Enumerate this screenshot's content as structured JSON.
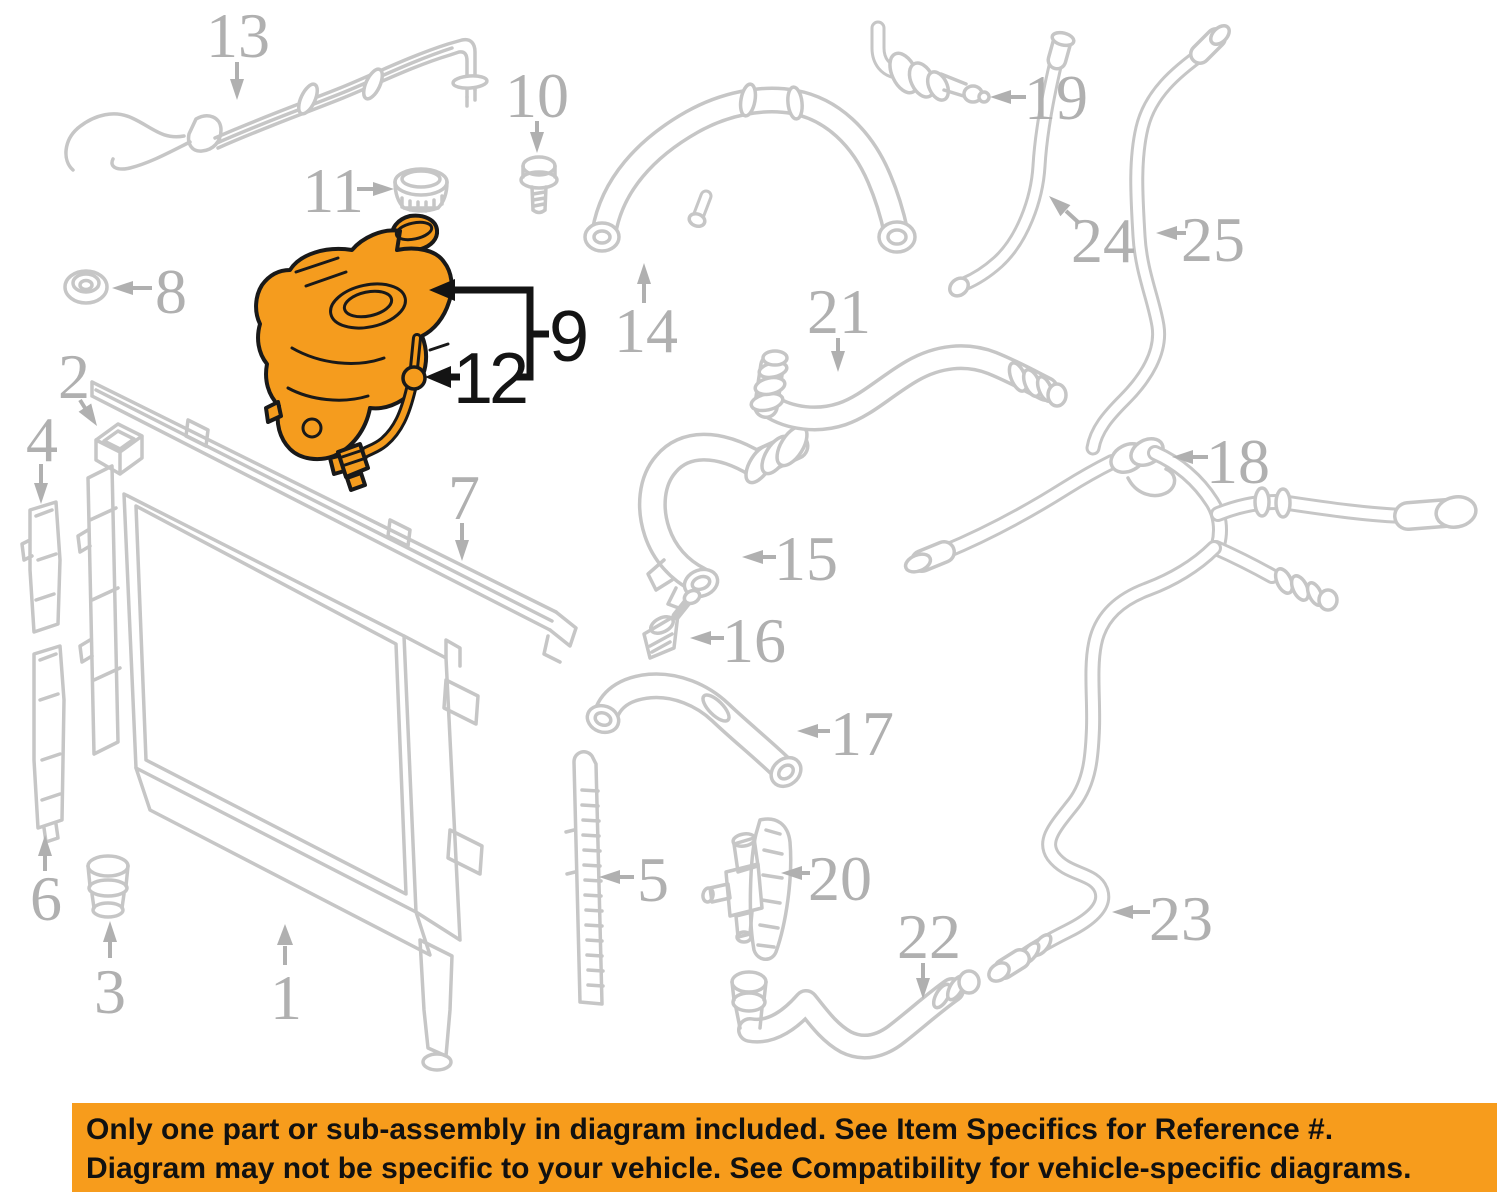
{
  "diagram": {
    "kind": "cooling-system parts diagram",
    "highlighted_parts": [
      "9",
      "12"
    ],
    "colors": {
      "background": "#ffffff",
      "part_line_gray": "#c6c6c6",
      "label_gray": "#b0b0b0",
      "highlight_orange": "#F59C1E",
      "highlight_outline": "#191919",
      "banner_orange": "#F79C1C",
      "banner_text": "#111111"
    }
  },
  "callouts": {
    "c1": {
      "label": "1"
    },
    "c2": {
      "label": "2"
    },
    "c3": {
      "label": "3"
    },
    "c4": {
      "label": "4"
    },
    "c5": {
      "label": "5"
    },
    "c6": {
      "label": "6"
    },
    "c7": {
      "label": "7"
    },
    "c8": {
      "label": "8"
    },
    "c9": {
      "label": "9"
    },
    "c10": {
      "label": "10"
    },
    "c11": {
      "label": "11"
    },
    "c12": {
      "label": "12"
    },
    "c13": {
      "label": "13"
    },
    "c14": {
      "label": "14"
    },
    "c15": {
      "label": "15"
    },
    "c16": {
      "label": "16"
    },
    "c17": {
      "label": "17"
    },
    "c18": {
      "label": "18"
    },
    "c19": {
      "label": "19"
    },
    "c20": {
      "label": "20"
    },
    "c21": {
      "label": "21"
    },
    "c22": {
      "label": "22"
    },
    "c23": {
      "label": "23"
    },
    "c24": {
      "label": "24"
    },
    "c25": {
      "label": "25"
    }
  },
  "banner": {
    "line1": "Only one part or sub-assembly in diagram included. See Item Specifics for Reference #.",
    "line2": "Diagram may not be specific to your vehicle. See Compatibility for vehicle-specific diagrams."
  }
}
